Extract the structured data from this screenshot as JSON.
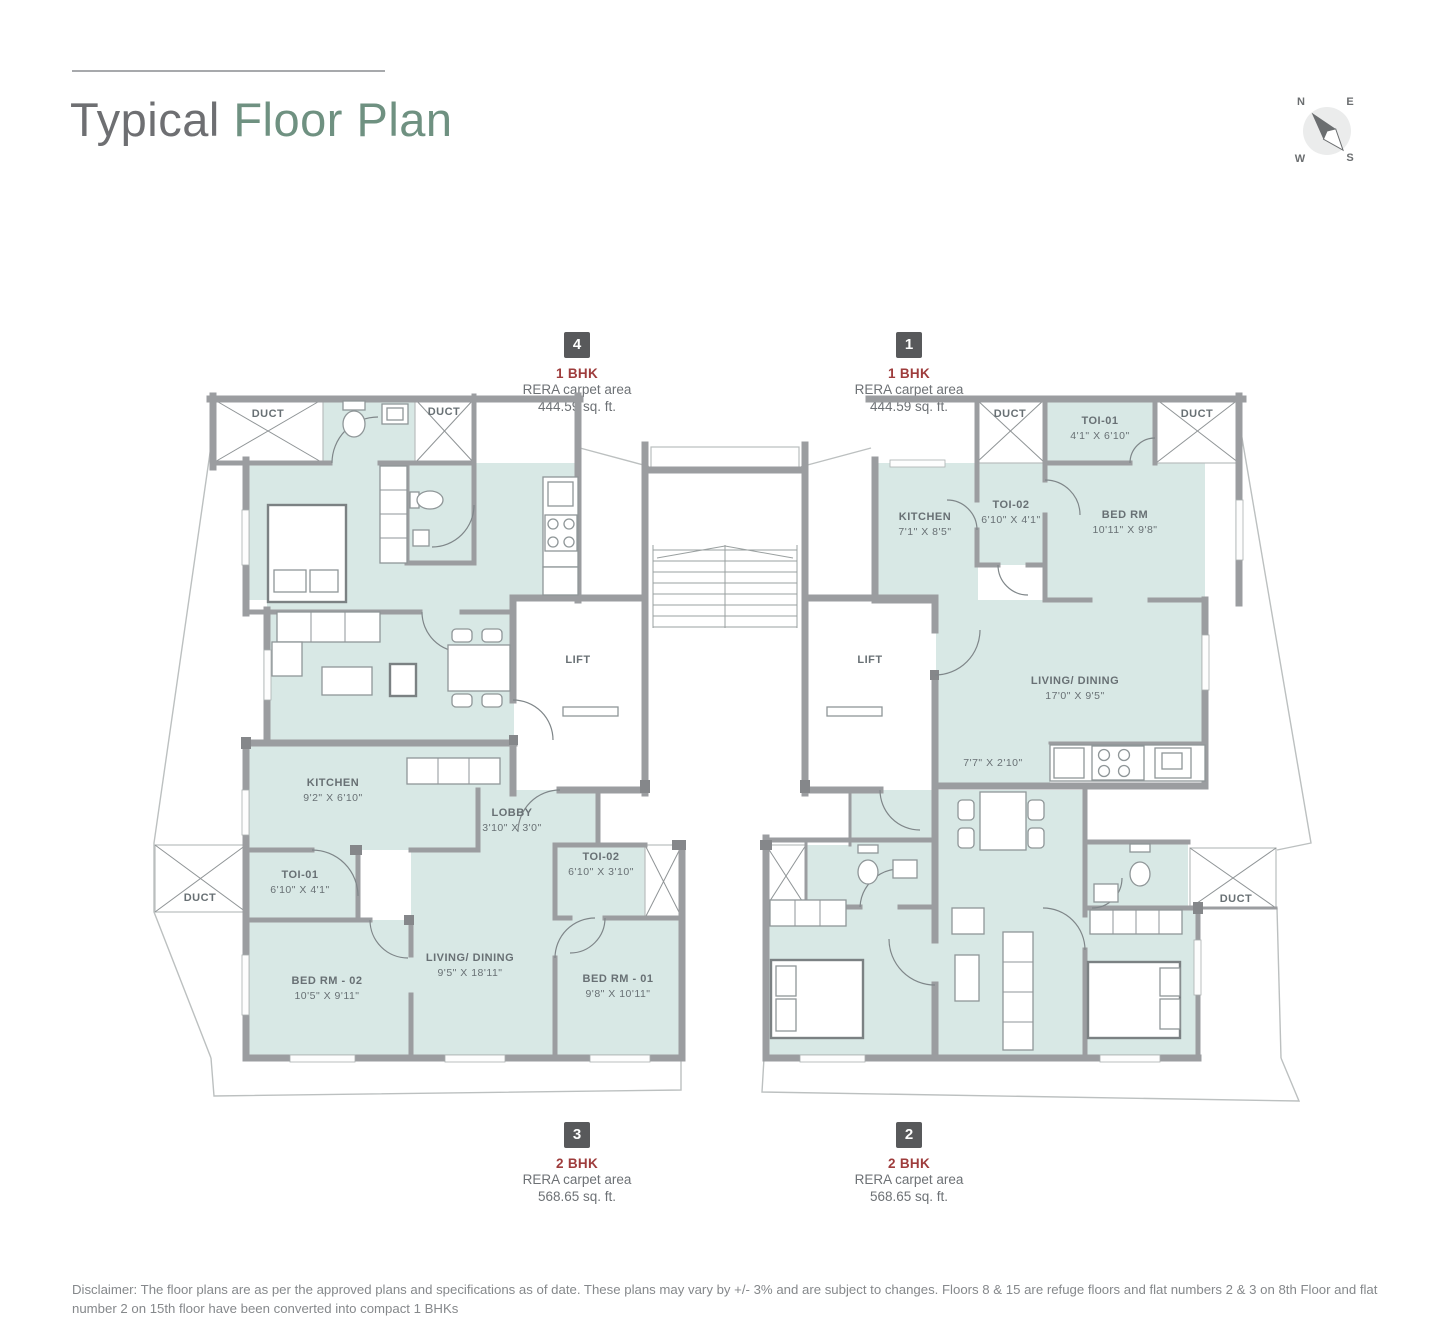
{
  "header": {
    "title_light": "Typical",
    "title_accent": "Floor Plan"
  },
  "compass": {
    "n": "N",
    "e": "E",
    "w": "W",
    "s": "S"
  },
  "unit_cards": [
    {
      "number": "4",
      "type": "1 BHK",
      "area_label": "RERA carpet area",
      "area": "444.59 sq. ft."
    },
    {
      "number": "1",
      "type": "1 BHK",
      "area_label": "RERA carpet area",
      "area": "444.59 sq. ft."
    },
    {
      "number": "3",
      "type": "2 BHK",
      "area_label": "RERA carpet area",
      "area": "568.65 sq. ft."
    },
    {
      "number": "2",
      "type": "2 BHK",
      "area_label": "RERA carpet area",
      "area": "568.65 sq. ft."
    }
  ],
  "plan": {
    "lift": "LIFT",
    "duct": "DUCT",
    "unit1": {
      "toi01_name": "TOI-01",
      "toi01_dim": "4'1\" X 6'10\"",
      "kitchen_name": "KITCHEN",
      "kitchen_dim": "7'1\" X 8'5\"",
      "toi02_name": "TOI-02",
      "toi02_dim": "6'10\" X 4'1\"",
      "bed_name": "BED RM",
      "bed_dim": "10'11\" X 9'8\"",
      "living_name": "LIVING/ DINING",
      "living_dim": "17'0\" X 9'5\"",
      "passage_dim": "7'7\" X 2'10\""
    },
    "unit3": {
      "kitchen_name": "KITCHEN",
      "kitchen_dim": "9'2\" X 6'10\"",
      "lobby_name": "LOBBY",
      "lobby_dim": "3'10\" X 3'0\"",
      "toi02_name": "TOI-02",
      "toi02_dim": "6'10\" X 3'10\"",
      "toi01_name": "TOI-01",
      "toi01_dim": "6'10\" X 4'1\"",
      "bed02_name": "BED RM - 02",
      "bed02_dim": "10'5\" X 9'11\"",
      "living_name": "LIVING/ DINING",
      "living_dim": "9'5\" X 18'11\"",
      "bed01_name": "BED RM - 01",
      "bed01_dim": "9'8\" X 10'11\""
    }
  },
  "disclaimer": "Disclaimer: The floor plans are as per the approved plans and specifications as of date. These plans may vary by +/- 3% and are subject to changes. Floors 8 & 15 are refuge floors and flat numbers 2 & 3 on 8th Floor and flat number 2 on 15th floor have been converted into compact 1 BHKs"
}
